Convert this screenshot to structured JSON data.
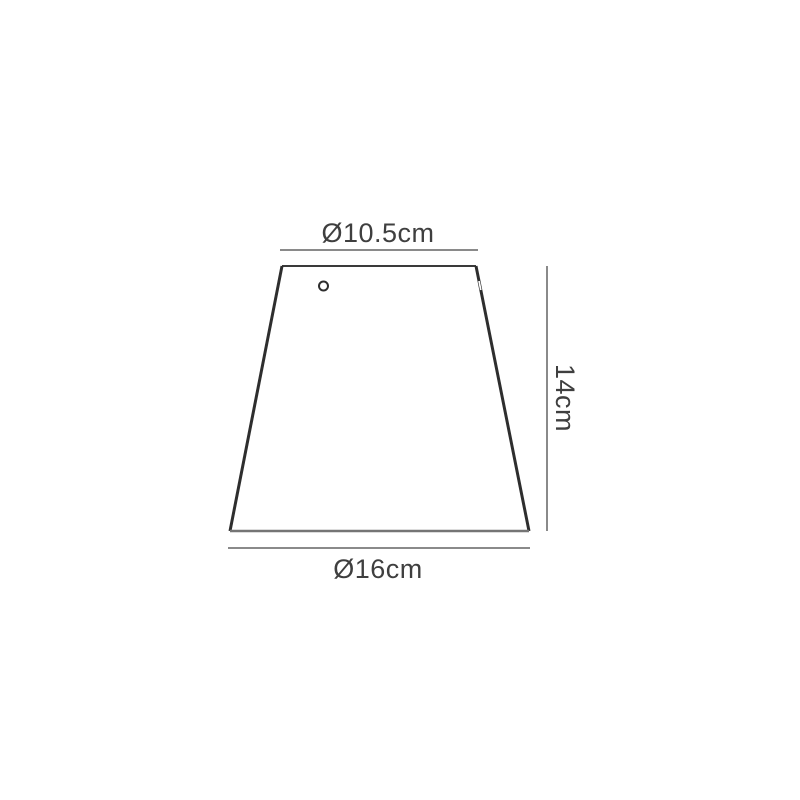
{
  "diagram": {
    "labels": {
      "top_diameter": "Ø10.5cm",
      "height": "14cm",
      "bottom_diameter": "Ø16cm"
    },
    "colors": {
      "shade_outline": "#2e2e2e",
      "shade_top_edge": "#3a3a3a",
      "shade_bottom_edge": "#757575",
      "dimension_line": "#8a8a8a",
      "label_text": "#3f3f3f",
      "background": "#ffffff"
    }
  }
}
